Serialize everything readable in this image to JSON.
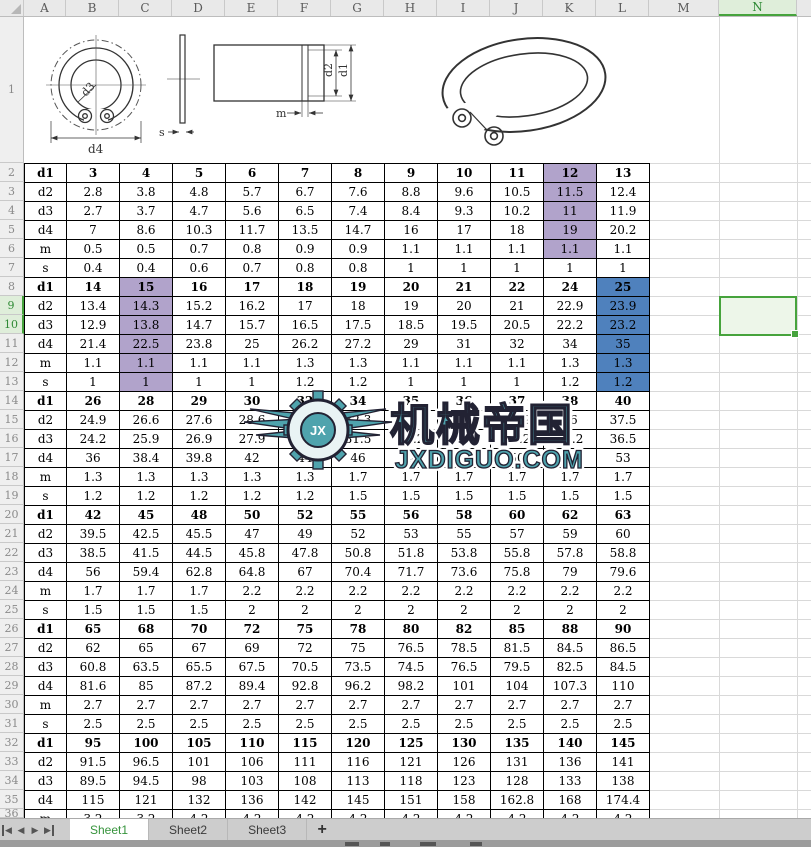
{
  "spreadsheet": {
    "column_headers": [
      "A",
      "B",
      "C",
      "D",
      "E",
      "F",
      "G",
      "H",
      "I",
      "J",
      "K",
      "L",
      "M",
      "N"
    ],
    "row_count": 36,
    "selected_columns": [
      "N"
    ],
    "selected_rows": [
      9,
      10
    ],
    "selection_range": "N9:N10"
  },
  "drawing_labels": {
    "d3": "d3",
    "d4": "d4",
    "s": "s",
    "d2": "d2",
    "d1": "d1",
    "m": "m"
  },
  "watermark": {
    "brand": "机械帝国",
    "site": "JXDIGUO.COM",
    "monogram": "JX",
    "color": "#4fa3ad"
  },
  "table": {
    "blocks": [
      {
        "rows": [
          {
            "label": "d1",
            "bold": true,
            "values": [
              "3",
              "4",
              "5",
              "6",
              "7",
              "8",
              "9",
              "10",
              "11",
              "12",
              "13"
            ]
          },
          {
            "label": "d2",
            "values": [
              "2.8",
              "3.8",
              "4.8",
              "5.7",
              "6.7",
              "7.6",
              "8.8",
              "9.6",
              "10.5",
              "11.5",
              "12.4"
            ]
          },
          {
            "label": "d3",
            "values": [
              "2.7",
              "3.7",
              "4.7",
              "5.6",
              "6.5",
              "7.4",
              "8.4",
              "9.3",
              "10.2",
              "11",
              "11.9"
            ]
          },
          {
            "label": "d4",
            "values": [
              "7",
              "8.6",
              "10.3",
              "11.7",
              "13.5",
              "14.7",
              "16",
              "17",
              "18",
              "19",
              "20.2"
            ]
          },
          {
            "label": "m",
            "values": [
              "0.5",
              "0.5",
              "0.7",
              "0.8",
              "0.9",
              "0.9",
              "1.1",
              "1.1",
              "1.1",
              "1.1",
              "1.1"
            ]
          },
          {
            "label": "s",
            "values": [
              "0.4",
              "0.4",
              "0.6",
              "0.7",
              "0.8",
              "0.8",
              "1",
              "1",
              "1",
              "1",
              "1"
            ]
          }
        ]
      },
      {
        "rows": [
          {
            "label": "d1",
            "bold": true,
            "values": [
              "14",
              "15",
              "16",
              "17",
              "18",
              "19",
              "20",
              "21",
              "22",
              "24",
              "25"
            ]
          },
          {
            "label": "d2",
            "values": [
              "13.4",
              "14.3",
              "15.2",
              "16.2",
              "17",
              "18",
              "19",
              "20",
              "21",
              "22.9",
              "23.9"
            ]
          },
          {
            "label": "d3",
            "values": [
              "12.9",
              "13.8",
              "14.7",
              "15.7",
              "16.5",
              "17.5",
              "18.5",
              "19.5",
              "20.5",
              "22.2",
              "23.2"
            ]
          },
          {
            "label": "d4",
            "values": [
              "21.4",
              "22.5",
              "23.8",
              "25",
              "26.2",
              "27.2",
              "29",
              "31",
              "32",
              "34",
              "35"
            ]
          },
          {
            "label": "m",
            "values": [
              "1.1",
              "1.1",
              "1.1",
              "1.1",
              "1.3",
              "1.3",
              "1.1",
              "1.1",
              "1.1",
              "1.3",
              "1.3"
            ]
          },
          {
            "label": "s",
            "values": [
              "1",
              "1",
              "1",
              "1",
              "1.2",
              "1.2",
              "1",
              "1",
              "1",
              "1.2",
              "1.2"
            ]
          }
        ]
      },
      {
        "rows": [
          {
            "label": "d1",
            "bold": true,
            "values": [
              "26",
              "28",
              "29",
              "30",
              "32",
              "34",
              "35",
              "36",
              "37",
              "38",
              "40"
            ]
          },
          {
            "label": "d2",
            "values": [
              "24.9",
              "26.6",
              "27.6",
              "28.6",
              "30.3",
              "32.3",
              "33",
              "33.9",
              "34.9",
              "36",
              "37.5"
            ]
          },
          {
            "label": "d3",
            "values": [
              "24.2",
              "25.9",
              "26.9",
              "27.9",
              "29.6",
              "31.5",
              "32.2",
              "33.2",
              "34.2",
              "35.2",
              "36.5"
            ]
          },
          {
            "label": "d4",
            "values": [
              "36",
              "38.4",
              "39.8",
              "42",
              "44",
              "46",
              "48",
              "49",
              "50",
              "51",
              "53"
            ]
          },
          {
            "label": "m",
            "values": [
              "1.3",
              "1.3",
              "1.3",
              "1.3",
              "1.3",
              "1.7",
              "1.7",
              "1.7",
              "1.7",
              "1.7",
              "1.7"
            ]
          },
          {
            "label": "s",
            "values": [
              "1.2",
              "1.2",
              "1.2",
              "1.2",
              "1.2",
              "1.5",
              "1.5",
              "1.5",
              "1.5",
              "1.5",
              "1.5"
            ]
          }
        ]
      },
      {
        "rows": [
          {
            "label": "d1",
            "bold": true,
            "values": [
              "42",
              "45",
              "48",
              "50",
              "52",
              "55",
              "56",
              "58",
              "60",
              "62",
              "63"
            ]
          },
          {
            "label": "d2",
            "values": [
              "39.5",
              "42.5",
              "45.5",
              "47",
              "49",
              "52",
              "53",
              "55",
              "57",
              "59",
              "60"
            ]
          },
          {
            "label": "d3",
            "values": [
              "38.5",
              "41.5",
              "44.5",
              "45.8",
              "47.8",
              "50.8",
              "51.8",
              "53.8",
              "55.8",
              "57.8",
              "58.8"
            ]
          },
          {
            "label": "d4",
            "values": [
              "56",
              "59.4",
              "62.8",
              "64.8",
              "67",
              "70.4",
              "71.7",
              "73.6",
              "75.8",
              "79",
              "79.6"
            ]
          },
          {
            "label": "m",
            "values": [
              "1.7",
              "1.7",
              "1.7",
              "2.2",
              "2.2",
              "2.2",
              "2.2",
              "2.2",
              "2.2",
              "2.2",
              "2.2"
            ]
          },
          {
            "label": "s",
            "values": [
              "1.5",
              "1.5",
              "1.5",
              "2",
              "2",
              "2",
              "2",
              "2",
              "2",
              "2",
              "2"
            ]
          }
        ]
      },
      {
        "rows": [
          {
            "label": "d1",
            "bold": true,
            "values": [
              "65",
              "68",
              "70",
              "72",
              "75",
              "78",
              "80",
              "82",
              "85",
              "88",
              "90"
            ]
          },
          {
            "label": "d2",
            "values": [
              "62",
              "65",
              "67",
              "69",
              "72",
              "75",
              "76.5",
              "78.5",
              "81.5",
              "84.5",
              "86.5"
            ]
          },
          {
            "label": "d3",
            "values": [
              "60.8",
              "63.5",
              "65.5",
              "67.5",
              "70.5",
              "73.5",
              "74.5",
              "76.5",
              "79.5",
              "82.5",
              "84.5"
            ]
          },
          {
            "label": "d4",
            "values": [
              "81.6",
              "85",
              "87.2",
              "89.4",
              "92.8",
              "96.2",
              "98.2",
              "101",
              "104",
              "107.3",
              "110"
            ]
          },
          {
            "label": "m",
            "values": [
              "2.7",
              "2.7",
              "2.7",
              "2.7",
              "2.7",
              "2.7",
              "2.7",
              "2.7",
              "2.7",
              "2.7",
              "2.7"
            ]
          },
          {
            "label": "s",
            "values": [
              "2.5",
              "2.5",
              "2.5",
              "2.5",
              "2.5",
              "2.5",
              "2.5",
              "2.5",
              "2.5",
              "2.5",
              "2.5"
            ]
          }
        ]
      },
      {
        "rows": [
          {
            "label": "d1",
            "bold": true,
            "values": [
              "95",
              "100",
              "105",
              "110",
              "115",
              "120",
              "125",
              "130",
              "135",
              "140",
              "145"
            ]
          },
          {
            "label": "d2",
            "values": [
              "91.5",
              "96.5",
              "101",
              "106",
              "111",
              "116",
              "121",
              "126",
              "131",
              "136",
              "141"
            ]
          },
          {
            "label": "d3",
            "values": [
              "89.5",
              "94.5",
              "98",
              "103",
              "108",
              "113",
              "118",
              "123",
              "128",
              "133",
              "138"
            ]
          },
          {
            "label": "d4",
            "values": [
              "115",
              "121",
              "132",
              "136",
              "142",
              "145",
              "151",
              "158",
              "162.8",
              "168",
              "174.4"
            ]
          },
          {
            "label": "m",
            "values": [
              "3.2",
              "3.2",
              "4.2",
              "4.2",
              "4.2",
              "4.2",
              "4.2",
              "4.2",
              "4.2",
              "4.2",
              "4.2"
            ]
          }
        ]
      }
    ],
    "highlights": [
      {
        "block": 0,
        "col": 9,
        "rows": [
          0,
          1,
          2,
          3,
          4
        ],
        "color": "purple"
      },
      {
        "block": 1,
        "col": 1,
        "rows": [
          0,
          1,
          2,
          3,
          4,
          5
        ],
        "color": "purple"
      },
      {
        "block": 1,
        "col": 10,
        "rows": [
          0,
          1,
          2,
          3,
          4,
          5
        ],
        "color": "blue"
      }
    ],
    "highlight_colors": {
      "purple": "#b1a3cb",
      "blue": "#4f81bd"
    }
  },
  "tabs": {
    "nav": [
      {
        "name": "first",
        "glyph": "◀",
        "bar": "left"
      },
      {
        "name": "prev",
        "glyph": "◀"
      },
      {
        "name": "next",
        "glyph": "▶"
      },
      {
        "name": "last",
        "glyph": "▶",
        "bar": "right"
      }
    ],
    "sheets": [
      {
        "label": "Sheet1",
        "active": true
      },
      {
        "label": "Sheet2",
        "active": false
      },
      {
        "label": "Sheet3",
        "active": false
      }
    ],
    "add_button": "+"
  }
}
